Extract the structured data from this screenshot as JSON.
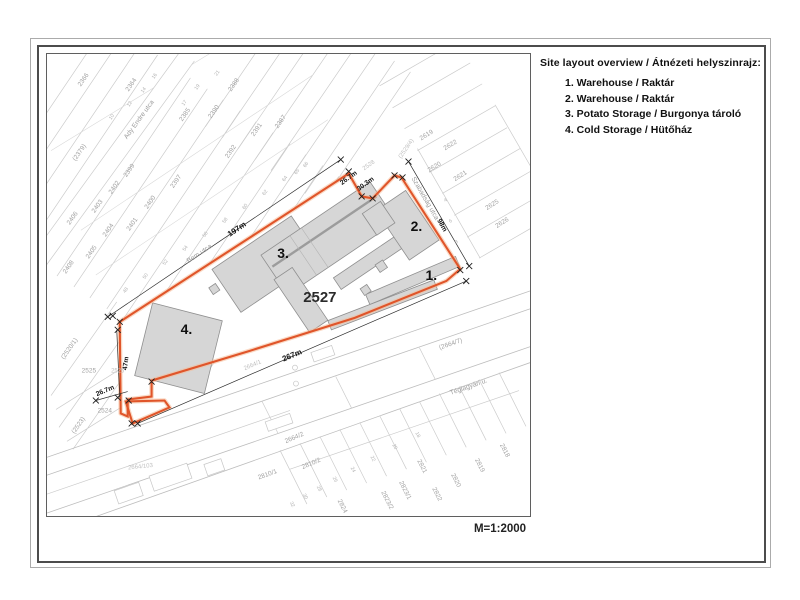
{
  "legend": {
    "title": "Site layout overview / Átnézeti helyszinrajz:",
    "items": [
      "1. Warehouse / Raktár",
      "2. Warehouse / Raktár",
      "3. Potato Storage / Burgonya tároló",
      "4. Cold Storage / Hütőház"
    ]
  },
  "scale_label": "M=1:2000",
  "map": {
    "site_parcel": "2527",
    "colors": {
      "boundary": "#e0552a",
      "building_fill": "#d6d6d6",
      "building_stroke": "#8f8f8f"
    },
    "labels": [
      {
        "t": "197m",
        "x": 238,
        "y": 231,
        "r": -34,
        "k": "dim"
      },
      {
        "t": "267m",
        "x": 293,
        "y": 358,
        "r": -23,
        "k": "dim"
      },
      {
        "t": "26.7m",
        "x": 350,
        "y": 179,
        "r": -36,
        "k": "dim2"
      },
      {
        "t": "30.3m",
        "x": 367,
        "y": 185,
        "r": -36,
        "k": "dim2"
      },
      {
        "t": "98m",
        "x": 441,
        "y": 226,
        "r": 60,
        "k": "dim2"
      },
      {
        "t": "47m",
        "x": 127,
        "y": 364,
        "r": -83,
        "k": "dim2"
      },
      {
        "t": "26.7m",
        "x": 105,
        "y": 393,
        "r": -23,
        "k": "dim2"
      },
      {
        "t": "Bem utca",
        "x": 200,
        "y": 255,
        "r": -34,
        "k": "street"
      },
      {
        "t": "Ady Endre utca",
        "x": 140,
        "y": 120,
        "r": -54,
        "k": "street"
      },
      {
        "t": "Szabadság utca",
        "x": 424,
        "y": 199,
        "r": 60,
        "k": "street"
      },
      {
        "t": "Téglagyári u.",
        "x": 470,
        "y": 389,
        "r": -19,
        "k": "street"
      },
      {
        "t": "2527",
        "x": 320,
        "y": 302,
        "r": 0,
        "k": "site"
      },
      {
        "t": "1.",
        "x": 432,
        "y": 280,
        "r": 0,
        "k": "bldg"
      },
      {
        "t": "2.",
        "x": 417,
        "y": 231,
        "r": 0,
        "k": "bldg"
      },
      {
        "t": "3.",
        "x": 283,
        "y": 258,
        "r": 0,
        "k": "bldg"
      },
      {
        "t": "4.",
        "x": 186,
        "y": 334,
        "r": 0,
        "k": "bldg"
      },
      {
        "t": "(2379)",
        "x": 80,
        "y": 153,
        "r": -55,
        "k": "parcel"
      },
      {
        "t": "2399",
        "x": 130,
        "y": 171,
        "r": -55,
        "k": "parcel"
      },
      {
        "t": "2402",
        "x": 115,
        "y": 188,
        "r": -55,
        "k": "parcel"
      },
      {
        "t": "2400",
        "x": 151,
        "y": 203,
        "r": -55,
        "k": "parcel"
      },
      {
        "t": "2397",
        "x": 177,
        "y": 182,
        "r": -55,
        "k": "parcel"
      },
      {
        "t": "2403",
        "x": 98,
        "y": 207,
        "r": -55,
        "k": "parcel"
      },
      {
        "t": "2401",
        "x": 133,
        "y": 225,
        "r": -55,
        "k": "parcel"
      },
      {
        "t": "2404",
        "x": 109,
        "y": 231,
        "r": -55,
        "k": "parcel"
      },
      {
        "t": "2405",
        "x": 92,
        "y": 253,
        "r": -55,
        "k": "parcel"
      },
      {
        "t": "2406",
        "x": 73,
        "y": 219,
        "r": -55,
        "k": "parcel"
      },
      {
        "t": "2408",
        "x": 69,
        "y": 268,
        "r": -55,
        "k": "parcel"
      },
      {
        "t": "2366",
        "x": 84,
        "y": 80,
        "r": -55,
        "k": "parcel"
      },
      {
        "t": "2364",
        "x": 132,
        "y": 85,
        "r": -55,
        "k": "parcel"
      },
      {
        "t": "2388",
        "x": 235,
        "y": 85,
        "r": -55,
        "k": "parcel"
      },
      {
        "t": "2390",
        "x": 215,
        "y": 112,
        "r": -55,
        "k": "parcel"
      },
      {
        "t": "2385",
        "x": 186,
        "y": 115,
        "r": -55,
        "k": "parcel"
      },
      {
        "t": "2387",
        "x": 282,
        "y": 122,
        "r": -55,
        "k": "parcel"
      },
      {
        "t": "2391",
        "x": 258,
        "y": 130,
        "r": -55,
        "k": "parcel"
      },
      {
        "t": "2392",
        "x": 232,
        "y": 152,
        "r": -55,
        "k": "parcel"
      },
      {
        "t": "2528",
        "x": 370,
        "y": 166,
        "r": -36,
        "k": "faint"
      },
      {
        "t": "(2529/4)",
        "x": 408,
        "y": 149,
        "r": -55,
        "k": "faint"
      },
      {
        "t": "2619",
        "x": 428,
        "y": 136,
        "r": -32,
        "k": "parcel"
      },
      {
        "t": "2622",
        "x": 452,
        "y": 146,
        "r": -32,
        "k": "parcel"
      },
      {
        "t": "2620",
        "x": 436,
        "y": 168,
        "r": -32,
        "k": "parcel"
      },
      {
        "t": "2621",
        "x": 462,
        "y": 177,
        "r": -32,
        "k": "parcel"
      },
      {
        "t": "2625",
        "x": 494,
        "y": 206,
        "r": -32,
        "k": "parcel"
      },
      {
        "t": "2626",
        "x": 504,
        "y": 224,
        "r": -32,
        "k": "parcel"
      },
      {
        "t": "2525",
        "x": 88,
        "y": 373,
        "r": 0,
        "k": "parcel"
      },
      {
        "t": "2526",
        "x": 117,
        "y": 373,
        "r": 0,
        "k": "faint"
      },
      {
        "t": "2524",
        "x": 104,
        "y": 413,
        "r": 0,
        "k": "parcel"
      },
      {
        "t": "(2523)",
        "x": 79,
        "y": 427,
        "r": -55,
        "k": "parcel"
      },
      {
        "t": "(2520/1)",
        "x": 70,
        "y": 350,
        "r": -55,
        "k": "parcel"
      },
      {
        "t": "2664/1",
        "x": 253,
        "y": 367,
        "r": -23,
        "k": "faint"
      },
      {
        "t": "(2664/7)",
        "x": 452,
        "y": 346,
        "r": -19,
        "k": "parcel"
      },
      {
        "t": "2664/2",
        "x": 295,
        "y": 440,
        "r": -23,
        "k": "parcel"
      },
      {
        "t": "2810/1",
        "x": 268,
        "y": 477,
        "r": -20,
        "k": "parcel"
      },
      {
        "t": "2810/2",
        "x": 312,
        "y": 466,
        "r": -23,
        "k": "parcel"
      },
      {
        "t": "2664/103",
        "x": 140,
        "y": 469,
        "r": -6,
        "k": "faint"
      },
      {
        "t": "2824",
        "x": 341,
        "y": 508,
        "r": 63,
        "k": "parcel"
      },
      {
        "t": "2823/2",
        "x": 386,
        "y": 502,
        "r": 63,
        "k": "parcel"
      },
      {
        "t": "2823/1",
        "x": 404,
        "y": 492,
        "r": 63,
        "k": "parcel"
      },
      {
        "t": "2821",
        "x": 421,
        "y": 468,
        "r": 63,
        "k": "parcel"
      },
      {
        "t": "2822",
        "x": 436,
        "y": 496,
        "r": 63,
        "k": "parcel"
      },
      {
        "t": "2820",
        "x": 455,
        "y": 482,
        "r": 63,
        "k": "parcel"
      },
      {
        "t": "2819",
        "x": 479,
        "y": 467,
        "r": 63,
        "k": "parcel"
      },
      {
        "t": "2818",
        "x": 504,
        "y": 452,
        "r": 63,
        "k": "parcel"
      },
      {
        "t": "48",
        "x": 126,
        "y": 291,
        "r": -55,
        "k": "house"
      },
      {
        "t": "50",
        "x": 146,
        "y": 277,
        "r": -55,
        "k": "house"
      },
      {
        "t": "52",
        "x": 166,
        "y": 263,
        "r": -55,
        "k": "house"
      },
      {
        "t": "54",
        "x": 186,
        "y": 249,
        "r": -55,
        "k": "house"
      },
      {
        "t": "56",
        "x": 206,
        "y": 235,
        "r": -55,
        "k": "house"
      },
      {
        "t": "58",
        "x": 226,
        "y": 221,
        "r": -55,
        "k": "house"
      },
      {
        "t": "60",
        "x": 246,
        "y": 207,
        "r": -55,
        "k": "house"
      },
      {
        "t": "62",
        "x": 266,
        "y": 193,
        "r": -55,
        "k": "house"
      },
      {
        "t": "64",
        "x": 286,
        "y": 179,
        "r": -55,
        "k": "house"
      },
      {
        "t": "65",
        "x": 298,
        "y": 172,
        "r": -55,
        "k": "house"
      },
      {
        "t": "66",
        "x": 307,
        "y": 165,
        "r": -55,
        "k": "house"
      },
      {
        "t": "10",
        "x": 112,
        "y": 117,
        "r": -55,
        "k": "house"
      },
      {
        "t": "12",
        "x": 130,
        "y": 104,
        "r": -55,
        "k": "house"
      },
      {
        "t": "14",
        "x": 144,
        "y": 90,
        "r": -55,
        "k": "house"
      },
      {
        "t": "16",
        "x": 155,
        "y": 76,
        "r": -55,
        "k": "house"
      },
      {
        "t": "17",
        "x": 185,
        "y": 103,
        "r": -55,
        "k": "house"
      },
      {
        "t": "19",
        "x": 198,
        "y": 87,
        "r": -55,
        "k": "house"
      },
      {
        "t": "21",
        "x": 218,
        "y": 73,
        "r": -55,
        "k": "house"
      },
      {
        "t": "32",
        "x": 291,
        "y": 506,
        "r": 63,
        "k": "house"
      },
      {
        "t": "30",
        "x": 304,
        "y": 498,
        "r": 63,
        "k": "house"
      },
      {
        "t": "28",
        "x": 318,
        "y": 490,
        "r": 63,
        "k": "house"
      },
      {
        "t": "26",
        "x": 334,
        "y": 481,
        "r": 63,
        "k": "house"
      },
      {
        "t": "24",
        "x": 352,
        "y": 471,
        "r": 63,
        "k": "house"
      },
      {
        "t": "22",
        "x": 372,
        "y": 460,
        "r": 63,
        "k": "house"
      },
      {
        "t": "20",
        "x": 394,
        "y": 448,
        "r": 63,
        "k": "house"
      },
      {
        "t": "18",
        "x": 417,
        "y": 436,
        "r": 63,
        "k": "house"
      },
      {
        "t": "4",
        "x": 447,
        "y": 201,
        "r": -32,
        "k": "house"
      },
      {
        "t": "6",
        "x": 452,
        "y": 222,
        "r": -32,
        "k": "house"
      },
      {
        "t": "8",
        "x": 458,
        "y": 243,
        "r": -32,
        "k": "house"
      }
    ]
  }
}
